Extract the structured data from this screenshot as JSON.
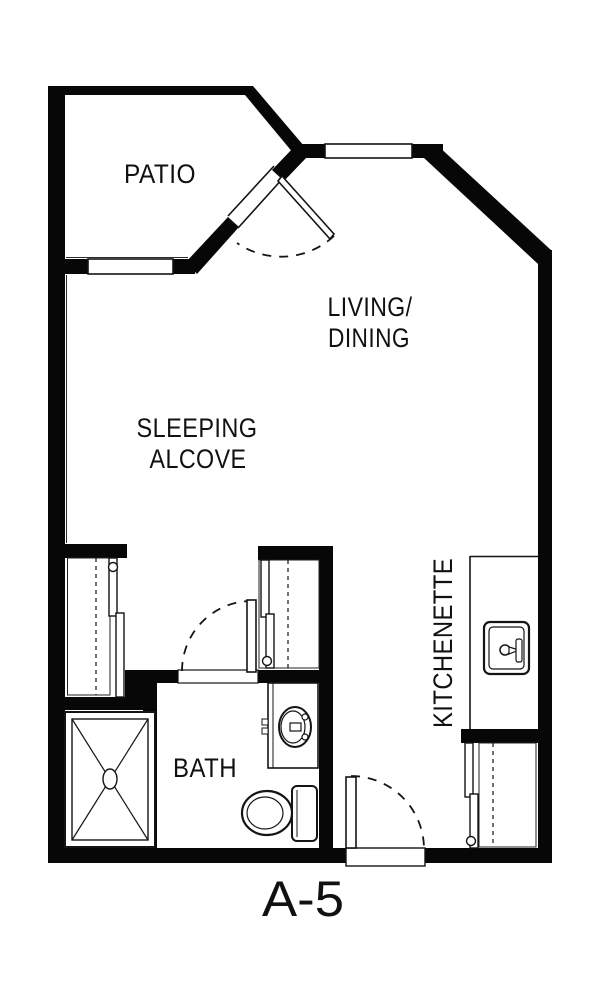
{
  "plan": {
    "unit_label": "A-5",
    "colors": {
      "wall": "#070707",
      "background": "#ffffff",
      "line": "#141414"
    },
    "rooms": {
      "patio": "PATIO",
      "living_dining_line1": "LIVING/",
      "living_dining_line2": "DINING",
      "sleeping_line1": "SLEEPING",
      "sleeping_line2": "ALCOVE",
      "bath": "BATH",
      "kitchenette": "KITCHENETTE"
    },
    "fixtures": {
      "shower": "shower-icon",
      "toilet": "toilet-icon",
      "vanity_sink": "bathroom-sink-icon",
      "kitchen_sink": "kitchen-sink-icon"
    }
  }
}
